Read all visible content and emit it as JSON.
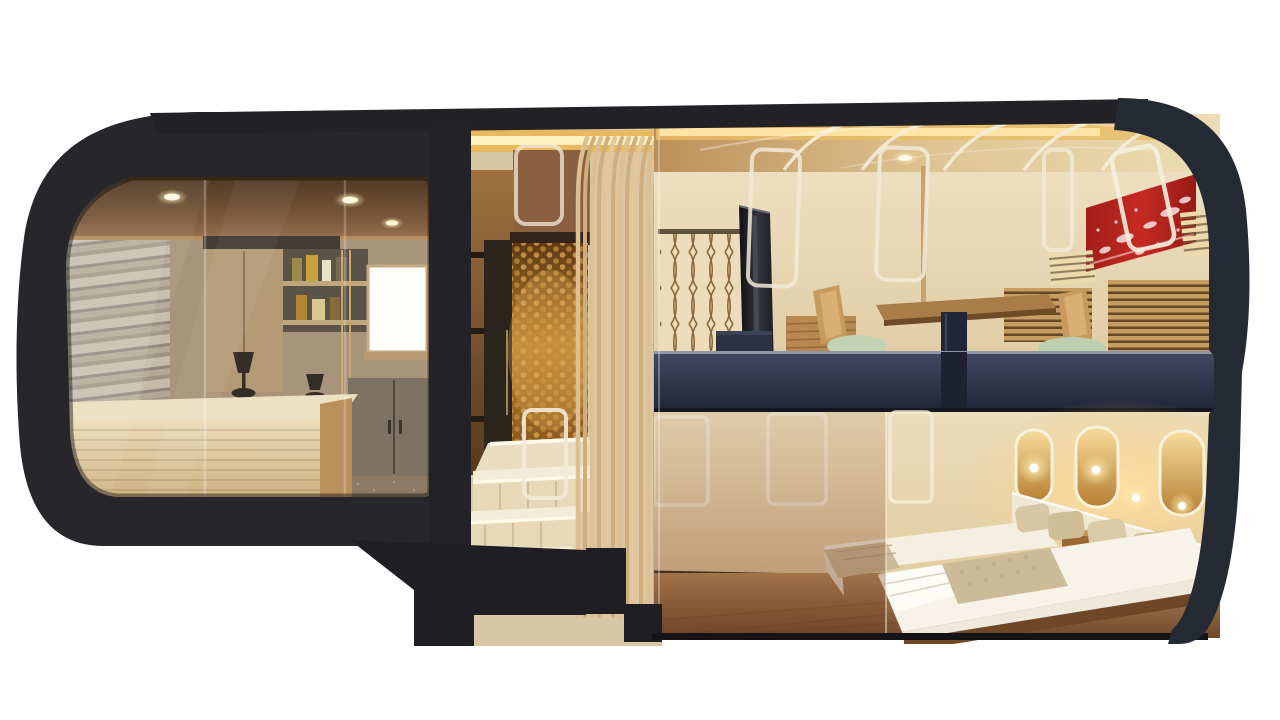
{
  "image": {
    "title": "Cutaway side-view rendering of a luxury sleeper train car",
    "type": "3d architectural rendering, no text in image",
    "background": "#ffffff"
  },
  "palette": {
    "body_shell": "#26262b",
    "roof_band": "#222226",
    "tail_cap": "#262a34",
    "navy_deck_band": "#2f3347",
    "gold_textured_wall": "#c08a3c",
    "wood_slats": "#d9ba8c",
    "cream_wall": "#e9dcbf",
    "lounge_ceiling": "#6b4a30",
    "counter_wood": "#dcc9a4",
    "stone_wall": "#b5a997",
    "red_art_panel": "#b2221e",
    "seat_cushion_green": "#bccfae",
    "floor_wood": "#a07047",
    "cove_glow": "#f7d98c",
    "stair_led": "#fff6d8"
  },
  "regions": {
    "lounge": {
      "label": "Front lounge bar room with stone wall, towel shelves, cabinets, window, wooden bar counter and two small lamps"
    },
    "entrance": {
      "label": "Entrance hall with gold textured wall, illuminated staircase and vertical wood slat screen"
    },
    "upper_deck": {
      "label": "Upper deck suite with pedestal table, wooden chairs with green cushions, red art panel, slatted vents and lattice screens"
    },
    "bedroom": {
      "label": "Lower deck bedroom with twin beds, beige pillows, white headboard and glowing arched wall lamps"
    },
    "shell": {
      "label": "Dark charcoal train car body shell with rounded nose and tail"
    }
  }
}
